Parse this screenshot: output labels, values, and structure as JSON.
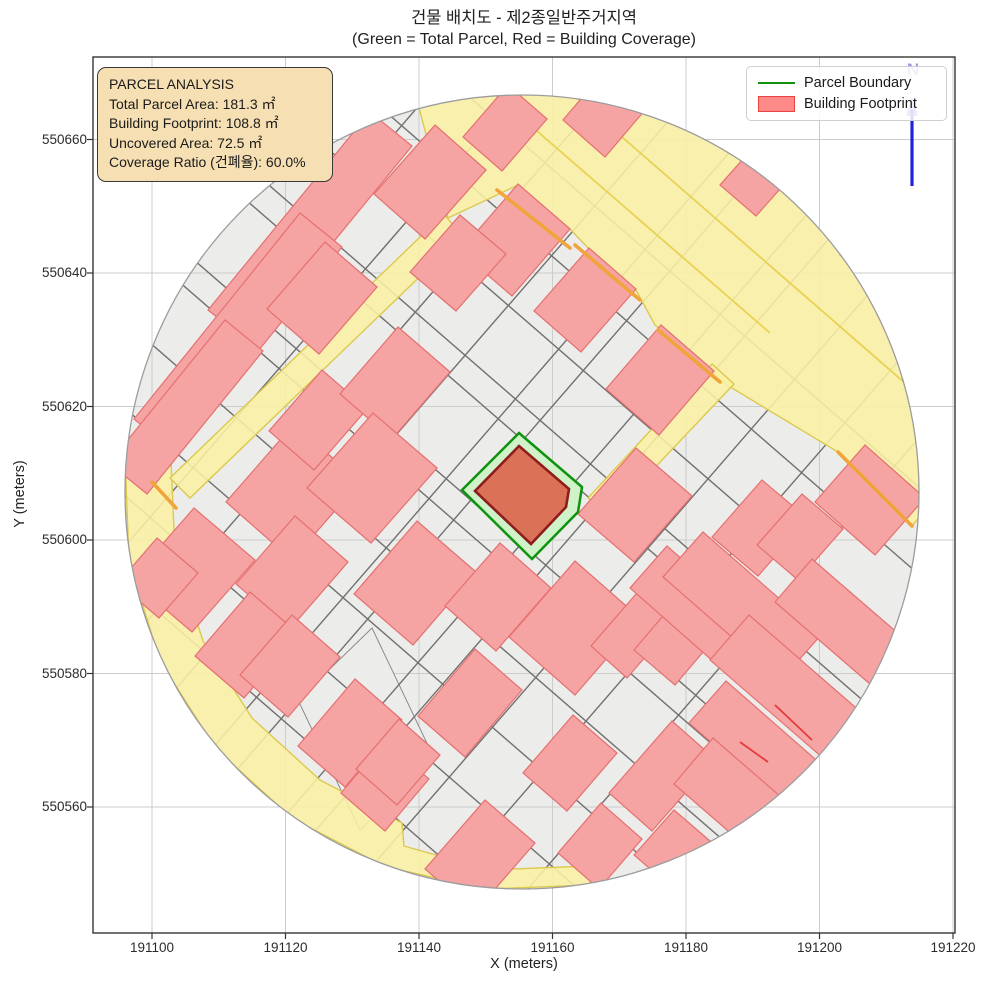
{
  "title": {
    "line1": "건물 배치도 - 제2종일반주거지역",
    "line2": "(Green = Total Parcel, Red = Building Coverage)"
  },
  "axes": {
    "xlabel": "X (meters)",
    "ylabel": "Y (meters)",
    "plot": {
      "left": 93,
      "top": 57,
      "right": 955,
      "bottom": 933
    },
    "xticks": [
      {
        "label": "191100",
        "px": 152
      },
      {
        "label": "191120",
        "px": 285.5
      },
      {
        "label": "191140",
        "px": 419
      },
      {
        "label": "191160",
        "px": 552.5
      },
      {
        "label": "191180",
        "px": 686
      },
      {
        "label": "191200",
        "px": 819.5
      },
      {
        "label": "191220",
        "px": 953
      }
    ],
    "yticks": [
      {
        "label": "550660",
        "py": 139.5
      },
      {
        "label": "550640",
        "py": 273
      },
      {
        "label": "550620",
        "py": 406.5
      },
      {
        "label": "550600",
        "py": 540
      },
      {
        "label": "550580",
        "py": 673.5
      },
      {
        "label": "550560",
        "py": 807
      }
    ]
  },
  "infobox": {
    "lines": [
      "PARCEL ANALYSIS",
      "Total Parcel Area: 181.3 ㎡",
      "Building Footprint: 108.8 ㎡",
      "Uncovered Area: 72.5 ㎡",
      "Coverage Ratio (건폐율): 60.0%"
    ]
  },
  "legend": {
    "items": [
      {
        "label": "Parcel Boundary",
        "swatch": "green-line"
      },
      {
        "label": "Building Footprint",
        "swatch": "red-patch"
      }
    ]
  },
  "north": {
    "label": "N"
  },
  "chart_data": {
    "type": "map",
    "title": "건물 배치도 - 제2종일반주거지역",
    "subtitle": "(Green = Total Parcel, Red = Building Coverage)",
    "zone": "제2종일반주거지역",
    "xlabel": "X (meters)",
    "ylabel": "Y (meters)",
    "xlim": [
      191091.2,
      191220.3
    ],
    "ylim": [
      550541.1,
      550672.4
    ],
    "xticks": [
      191100,
      191120,
      191140,
      191160,
      191180,
      191200,
      191220
    ],
    "yticks": [
      550560,
      550580,
      550600,
      550620,
      550640,
      550660
    ],
    "grid": true,
    "legend_position": "upper right",
    "analysis": {
      "total_parcel_area_m2": 181.3,
      "building_footprint_m2": 108.8,
      "uncovered_area_m2": 72.5,
      "coverage_ratio_pct": 60.0
    },
    "buffer_circle": {
      "center_x": 191155.4,
      "center_y": 550607.2,
      "radius_m": 60
    },
    "highlight_parcel_xy": [
      [
        191155.0,
        550616.0
      ],
      [
        191164.4,
        550607.9
      ],
      [
        191163.8,
        550604.2
      ],
      [
        191156.9,
        550597.2
      ],
      [
        191146.4,
        550607.5
      ]
    ],
    "highlight_building_xy": [
      [
        191155.0,
        550614.1
      ],
      [
        191162.5,
        550607.6
      ],
      [
        191162.0,
        550604.9
      ],
      [
        191156.8,
        550599.4
      ],
      [
        191148.4,
        550607.3
      ]
    ],
    "layers": [
      "parcels (gray)",
      "roads (yellow)",
      "buildings (red)",
      "parcel boundary (green)",
      "building footprint (dark red)",
      "north arrow (blue)"
    ]
  },
  "map": {
    "colors": {
      "bg": "#ECECEA",
      "circle_edge": "#9C9C9C",
      "grid": "#CCCCCC",
      "frame": "#262626",
      "parcel_line": "#707070",
      "patch_fill": "#ECECEA",
      "patch_edge": "#8A8A8A",
      "building_fill": "#F5A4A3",
      "building_edge": "#E57070",
      "road_fill": "#FAF0A4",
      "road_edge": "#DCC94E",
      "road_line": "#E8D254",
      "orange": "#F0A43A",
      "red_line": "#E23B3B",
      "parcel_fill": "#CFF2C8",
      "parcel_edge": "#0F930F",
      "bfp_fill": "#DB7257",
      "bfp_edge": "#8F1D1D",
      "north": "#2222DD"
    },
    "circle": {
      "cx": 522,
      "cy": 492,
      "r": 397
    },
    "basis": {
      "u": [
        0.656,
        -0.755
      ],
      "v": [
        0.755,
        0.656
      ],
      "u2": [
        0.63,
        -0.777
      ],
      "v2": [
        0.777,
        0.63
      ]
    },
    "patches": [
      {
        "pts": [
          [
            128,
            578
          ],
          [
            158,
            546
          ],
          [
            190,
            578
          ],
          [
            158,
            612
          ]
        ]
      },
      {
        "pts": [
          [
            298,
            700
          ],
          [
            372,
            628
          ],
          [
            434,
            758
          ],
          [
            360,
            830
          ]
        ]
      }
    ],
    "parcel_lines": [
      {
        "p1": [
          -23,
          615
        ],
        "p2": [
          567,
          -65
        ]
      },
      {
        "p1": [
          27,
          659
        ],
        "p2": [
          617,
          -21
        ]
      },
      {
        "p1": [
          77,
          702
        ],
        "p2": [
          667,
          22
        ]
      },
      {
        "p1": [
          127,
          745
        ],
        "p2": [
          717,
          65
        ]
      },
      {
        "p1": [
          177,
          789
        ],
        "p2": [
          767,
          109
        ]
      },
      {
        "p1": [
          202,
          810
        ],
        "p2": [
          792,
          130
        ]
      },
      {
        "p1": [
          252,
          854
        ],
        "p2": [
          842,
          174
        ]
      },
      {
        "p1": [
          277,
          875
        ],
        "p2": [
          867,
          195
        ]
      },
      {
        "p1": [
          327,
          918
        ],
        "p2": [
          917,
          238
        ]
      },
      {
        "p1": [
          377,
          962
        ],
        "p2": [
          967,
          282
        ]
      },
      {
        "p1": [
          427,
          1005
        ],
        "p2": [
          1017,
          325
        ]
      },
      {
        "p1": [
          -33,
          446
        ],
        "p2": [
          647,
          1036
        ]
      },
      {
        "p1": [
          10,
          396
        ],
        "p2": [
          690,
          986
        ]
      },
      {
        "p1": [
          53,
          346
        ],
        "p2": [
          733,
          936
        ]
      },
      {
        "p1": [
          96,
          296
        ],
        "p2": [
          776,
          886
        ]
      },
      {
        "p1": [
          139,
          247
        ],
        "p2": [
          819,
          837
        ]
      },
      {
        "p1": [
          156,
          227
        ],
        "p2": [
          836,
          817
        ]
      },
      {
        "p1": [
          208,
          167
        ],
        "p2": [
          888,
          757
        ]
      },
      {
        "p1": [
          225,
          147
        ],
        "p2": [
          905,
          737
        ]
      },
      {
        "p1": [
          268,
          97
        ],
        "p2": [
          948,
          687
        ]
      },
      {
        "p1": [
          311,
          47
        ],
        "p2": [
          991,
          637
        ]
      },
      {
        "p1": [
          354,
          -3
        ],
        "p2": [
          1034,
          587
        ]
      }
    ],
    "roads": [
      {
        "pts": [
          [
            417,
            100
          ],
          [
            448,
            218
          ],
          [
            518,
            185
          ],
          [
            570,
            229
          ],
          [
            590,
            250
          ],
          [
            636,
            290
          ],
          [
            655,
            325
          ],
          [
            714,
            372
          ],
          [
            722,
            382
          ],
          [
            838,
            452
          ],
          [
            912,
            526
          ],
          [
            1100,
            300
          ],
          [
            800,
            -100
          ]
        ]
      },
      {
        "pts": [
          [
            125,
            457
          ],
          [
            129,
            561
          ],
          [
            160,
            661
          ],
          [
            216,
            749
          ],
          [
            293,
            819
          ],
          [
            386,
            867
          ],
          [
            487,
            889
          ],
          [
            591,
            885
          ],
          [
            588,
            866
          ],
          [
            489,
            870
          ],
          [
            404,
            846
          ],
          [
            402,
            823
          ],
          [
            320,
            780
          ],
          [
            252,
            718
          ],
          [
            203,
            641
          ],
          [
            175,
            553
          ],
          [
            171,
            461
          ]
        ]
      },
      {
        "pts": [
          [
            444,
            214
          ],
          [
            170,
            478
          ],
          [
            190,
            498
          ],
          [
            462,
            236
          ]
        ]
      },
      {
        "pts": [
          [
            588,
            498
          ],
          [
            712,
            364
          ],
          [
            734,
            384
          ],
          [
            608,
            517
          ]
        ]
      }
    ],
    "road_lines": [
      {
        "p1": [
          455,
          60
        ],
        "p2": [
          770,
          333
        ]
      },
      {
        "p1": [
          530,
          57
        ],
        "p2": [
          913,
          390
        ]
      },
      {
        "p1": [
          700,
          57
        ],
        "p2": [
          990,
          306
        ]
      }
    ],
    "buildings": [
      {
        "x": 310,
        "y": 228,
        "a": 128,
        "b": 27,
        "k": 2
      },
      {
        "x": 238,
        "y": 333,
        "a": 132,
        "b": 27,
        "k": 2
      },
      {
        "x": 186,
        "y": 407,
        "a": 92,
        "b": 25,
        "k": 2
      },
      {
        "x": 430,
        "y": 182,
        "a": 46,
        "b": 34
      },
      {
        "x": 610,
        "y": 108,
        "a": 40,
        "b": 28
      },
      {
        "x": 505,
        "y": 128,
        "a": 34,
        "b": 26
      },
      {
        "x": 515,
        "y": 240,
        "a": 44,
        "b": 34
      },
      {
        "x": 585,
        "y": 300,
        "a": 42,
        "b": 31
      },
      {
        "x": 660,
        "y": 380,
        "a": 42,
        "b": 35
      },
      {
        "x": 758,
        "y": 178,
        "a": 30,
        "b": 24
      },
      {
        "x": 806,
        "y": 122,
        "a": 28,
        "b": 22
      },
      {
        "x": 872,
        "y": 248,
        "a": 26,
        "b": 20
      },
      {
        "x": 870,
        "y": 500,
        "a": 38,
        "b": 40
      },
      {
        "x": 293,
        "y": 492,
        "a": 52,
        "b": 44
      },
      {
        "x": 193,
        "y": 570,
        "a": 48,
        "b": 40
      },
      {
        "x": 292,
        "y": 573,
        "a": 45,
        "b": 35
      },
      {
        "x": 158,
        "y": 578,
        "a": 30,
        "b": 27
      },
      {
        "x": 247,
        "y": 645,
        "a": 42,
        "b": 32
      },
      {
        "x": 290,
        "y": 666,
        "a": 40,
        "b": 32
      },
      {
        "x": 350,
        "y": 733,
        "a": 44,
        "b": 31
      },
      {
        "x": 385,
        "y": 786,
        "a": 34,
        "b": 29
      },
      {
        "x": 318,
        "y": 420,
        "a": 40,
        "b": 30
      },
      {
        "x": 395,
        "y": 383,
        "a": 44,
        "b": 34
      },
      {
        "x": 322,
        "y": 298,
        "a": 44,
        "b": 34
      },
      {
        "x": 458,
        "y": 263,
        "a": 38,
        "b": 30
      },
      {
        "x": 372,
        "y": 478,
        "a": 50,
        "b": 42
      },
      {
        "x": 415,
        "y": 583,
        "a": 48,
        "b": 39
      },
      {
        "x": 498,
        "y": 597,
        "a": 42,
        "b": 34
      },
      {
        "x": 575,
        "y": 628,
        "a": 50,
        "b": 44
      },
      {
        "x": 470,
        "y": 703,
        "a": 44,
        "b": 31
      },
      {
        "x": 398,
        "y": 762,
        "a": 33,
        "b": 27
      },
      {
        "x": 480,
        "y": 856,
        "a": 46,
        "b": 33
      },
      {
        "x": 570,
        "y": 763,
        "a": 38,
        "b": 29
      },
      {
        "x": 600,
        "y": 846,
        "a": 33,
        "b": 27
      },
      {
        "x": 635,
        "y": 632,
        "a": 40,
        "b": 24
      },
      {
        "x": 683,
        "y": 634,
        "a": 44,
        "b": 27
      },
      {
        "x": 662,
        "y": 776,
        "a": 48,
        "b": 29
      },
      {
        "x": 635,
        "y": 505,
        "a": 44,
        "b": 37
      },
      {
        "x": 760,
        "y": 528,
        "a": 38,
        "b": 30
      },
      {
        "x": 800,
        "y": 537,
        "a": 34,
        "b": 27
      },
      {
        "x": 695,
        "y": 608,
        "a": 28,
        "b": 62
      },
      {
        "x": 742,
        "y": 606,
        "a": 30,
        "b": 78
      },
      {
        "x": 845,
        "y": 625,
        "a": 28,
        "b": 68
      },
      {
        "x": 790,
        "y": 690,
        "a": 30,
        "b": 80
      },
      {
        "x": 760,
        "y": 748,
        "a": 28,
        "b": 70
      },
      {
        "x": 735,
        "y": 797,
        "a": 30,
        "b": 55
      },
      {
        "x": 672,
        "y": 848,
        "a": 30,
        "b": 24
      }
    ],
    "orange_edges": [
      {
        "p1": [
          575,
          245
        ],
        "p2": [
          640,
          300
        ]
      },
      {
        "p1": [
          658,
          330
        ],
        "p2": [
          720,
          382
        ]
      },
      {
        "p1": [
          838,
          452
        ],
        "p2": [
          912,
          526
        ]
      },
      {
        "p1": [
          497,
          190
        ],
        "p2": [
          570,
          248
        ]
      },
      {
        "p1": [
          152,
          482
        ],
        "p2": [
          176,
          508
        ]
      }
    ],
    "red_edges": [
      {
        "p1": [
          775,
          705
        ],
        "p2": [
          812,
          740
        ]
      },
      {
        "p1": [
          740,
          742
        ],
        "p2": [
          768,
          762
        ]
      }
    ],
    "highlight_parcel": {
      "pts": [
        [
          519,
          433
        ],
        [
          582,
          487
        ],
        [
          578,
          512
        ],
        [
          532,
          559
        ],
        [
          462,
          490
        ]
      ]
    },
    "highlight_building": {
      "pts": [
        [
          519,
          446
        ],
        [
          569,
          489
        ],
        [
          566,
          507
        ],
        [
          531,
          544
        ],
        [
          475,
          491
        ]
      ]
    },
    "north_arrow": {
      "x": 912,
      "y1": 186,
      "y2": 110,
      "head": [
        [
          906,
          116
        ],
        [
          918,
          116
        ],
        [
          912,
          97
        ]
      ]
    }
  }
}
